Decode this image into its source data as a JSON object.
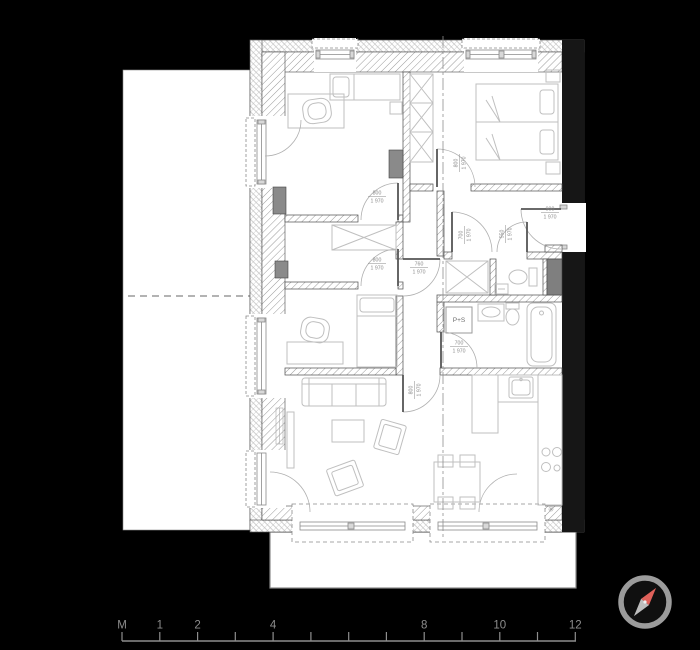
{
  "colors": {
    "background": "#000000",
    "paper": "#ffffff",
    "wall_hatch": "#9a9a9a",
    "party_wall": "#161616",
    "furniture": "#bfbfbf",
    "dimension_text": "#8a8a8a",
    "scale_text": "#8e8e8e",
    "compass_ring": "#9c9c9c",
    "compass_north": "#e0615a",
    "compass_south": "#bdbdbd"
  },
  "plan": {
    "washer_dryer_label": "P+S",
    "freezer_symbol": "✳",
    "door_labels": [
      {
        "name": "bedroom1-door-dimension",
        "width_mm": "800",
        "height_mm": "1 970",
        "x": 377,
        "y": 196,
        "rotate": 0
      },
      {
        "name": "bedroom2-door-dimension",
        "width_mm": "800",
        "height_mm": "1 970",
        "x": 459,
        "y": 163,
        "rotate": -90
      },
      {
        "name": "entrance-door-dimension",
        "width_mm": "900",
        "height_mm": "1 970",
        "x": 550,
        "y": 212,
        "rotate": 0
      },
      {
        "name": "corridor-door-dimension",
        "width_mm": "760",
        "height_mm": "1 970",
        "x": 419,
        "y": 267,
        "rotate": 0
      },
      {
        "name": "storage-door-dimension",
        "width_mm": "700",
        "height_mm": "1 970",
        "x": 464,
        "y": 235,
        "rotate": -90
      },
      {
        "name": "wc-door-dimension",
        "width_mm": "550",
        "height_mm": "1 970",
        "x": 505,
        "y": 234,
        "rotate": -90
      },
      {
        "name": "bathroom-door-dimension",
        "width_mm": "700",
        "height_mm": "1 970",
        "x": 459,
        "y": 346,
        "rotate": 0
      },
      {
        "name": "bedroom3-door-dimension",
        "width_mm": "800",
        "height_mm": "1 970",
        "x": 377,
        "y": 263,
        "rotate": 0
      },
      {
        "name": "living-room-door-dimension",
        "width_mm": "800",
        "height_mm": "1 970",
        "x": 414,
        "y": 390,
        "rotate": -90
      }
    ]
  },
  "scale_bar": {
    "baseline_y": 641,
    "x_start": 122,
    "x_end": 576,
    "tick_height": 9,
    "ticks": [
      {
        "x": 122,
        "label": "M"
      },
      {
        "x": 159.8,
        "label": "1"
      },
      {
        "x": 197.6,
        "label": "2"
      },
      {
        "x": 235.3,
        "label": ""
      },
      {
        "x": 273.1,
        "label": "4"
      },
      {
        "x": 310.9,
        "label": ""
      },
      {
        "x": 348.7,
        "label": ""
      },
      {
        "x": 386.4,
        "label": ""
      },
      {
        "x": 424.2,
        "label": "8"
      },
      {
        "x": 462.0,
        "label": ""
      },
      {
        "x": 499.8,
        "label": "10"
      },
      {
        "x": 537.5,
        "label": ""
      },
      {
        "x": 575.3,
        "label": "12"
      }
    ]
  }
}
